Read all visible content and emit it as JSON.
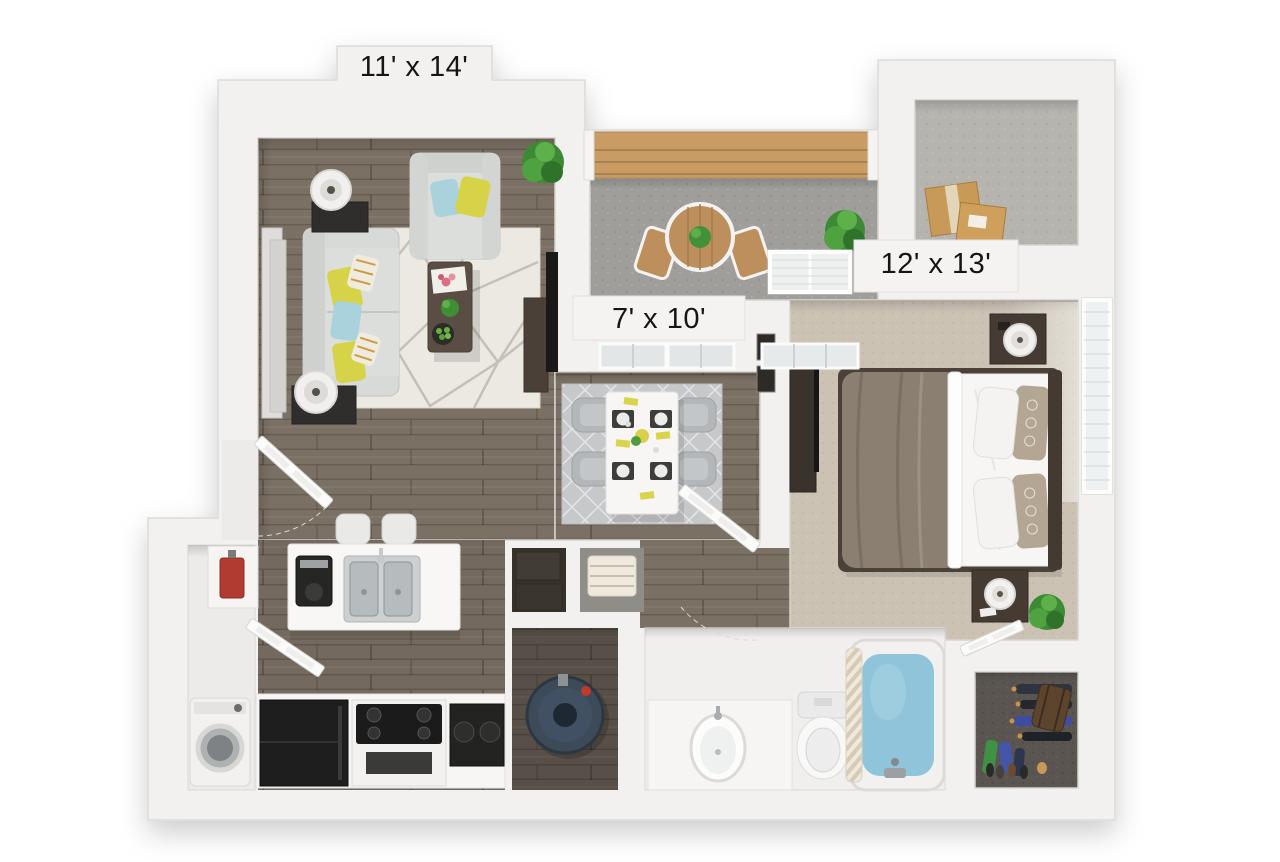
{
  "floorplan": {
    "type": "3d-top-down-floor-plan",
    "background": "#ffffff",
    "rooms": {
      "living_room": {
        "label": "11' x 14'"
      },
      "balcony": {
        "label": "7' x 10'"
      },
      "bedroom": {
        "label": "12' x 13'"
      }
    },
    "colors": {
      "walls": "#f2f1ef",
      "wood_floor": "#7b7064",
      "bedroom_carpet": "#cbc2b4",
      "storage_carpet": "#b6b4af",
      "closet_carpet": "#5a5550",
      "balcony_concrete": "#9f9e9b",
      "railing_wood": "#c89c62",
      "pillow_yellow": "#d7d348",
      "pillow_blue": "#a9d2dc",
      "tub_water": "#8fc4da",
      "plant_green": "#3c8a34",
      "cardboard_box": "#c79a57",
      "appliance_black": "#1e1e1e",
      "fire_riser_red": "#b23b31",
      "water_heater_navy": "#3d4b59",
      "label_text": "#151515"
    }
  }
}
